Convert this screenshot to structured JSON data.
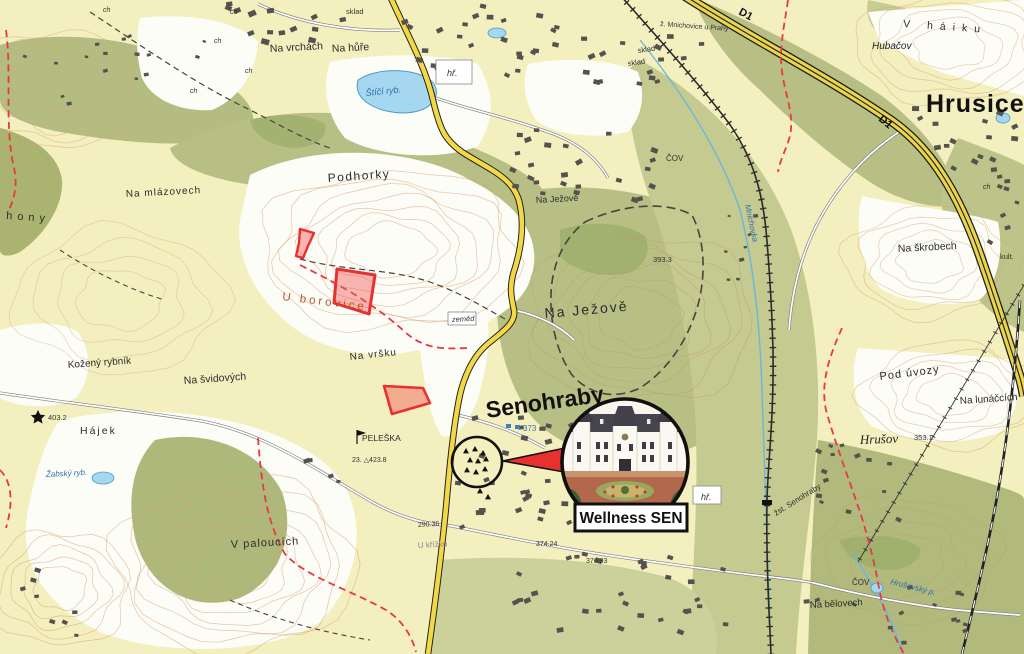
{
  "map": {
    "settlements": {
      "hrusice": "Hrusice",
      "senohraby": "Senohraby",
      "hrusov": "Hrušov",
      "hubacov": "Hubačov"
    },
    "localities": {
      "podhorky": "Podhorky",
      "na_jezove_small": "Na Ježově",
      "na_jezove": "Na Ježově",
      "na_vrchach": "Na vrchách",
      "na_hure": "Na hůře",
      "na_mlazovech": "Na mlázovech",
      "u_borovice": "U borovice",
      "na_vrsku": "Na vršku",
      "kozeny_rybnik": "Kožený rybník",
      "na_svidovych": "Na švidových",
      "hajek": "Hájek",
      "v_paloucich": "V paloucích",
      "pod_uvozy": "Pod úvozy",
      "na_lunaccich": "Na lunáčcích",
      "na_skrobech": "Na škrobech",
      "v_haiku": "V háiku",
      "na_belovech": "Na bělovech",
      "peleska": "PELEŠKA",
      "u_krizku": "U křížku",
      "hony": "hony"
    },
    "water": {
      "stici": "Štíčí ryb.",
      "zabsky": "Žabský ryb.",
      "mnichovka": "Mnichovka",
      "hrusovsky": "Hrušovský p."
    },
    "infrastructure": {
      "cov": "ČOV",
      "hr": "hř.",
      "sklad": "sklad",
      "zemed": "zeměd",
      "station": "žst. Senohraby",
      "rail_stop": "ž. Mnichovice u Prahy",
      "kult": "kult.",
      "ch": "ch",
      "d1": "D1"
    },
    "elevations": {
      "e393": "393.3",
      "e373": "373",
      "e403": "403.2",
      "e423": "23. △423.8",
      "e353": "353.1",
      "e290": "290.36",
      "e374": "374.24",
      "e376": "376.93"
    },
    "colors": {
      "field": "#f4efbe",
      "forest": "#bdc489",
      "forest_dark": "#a3b071",
      "water": "#a6d7f0",
      "road_yellow": "#f2d847",
      "highlight_red": "#e8312e",
      "contour": "#d7a477"
    }
  },
  "callout": {
    "title": "Wellness SEN"
  }
}
